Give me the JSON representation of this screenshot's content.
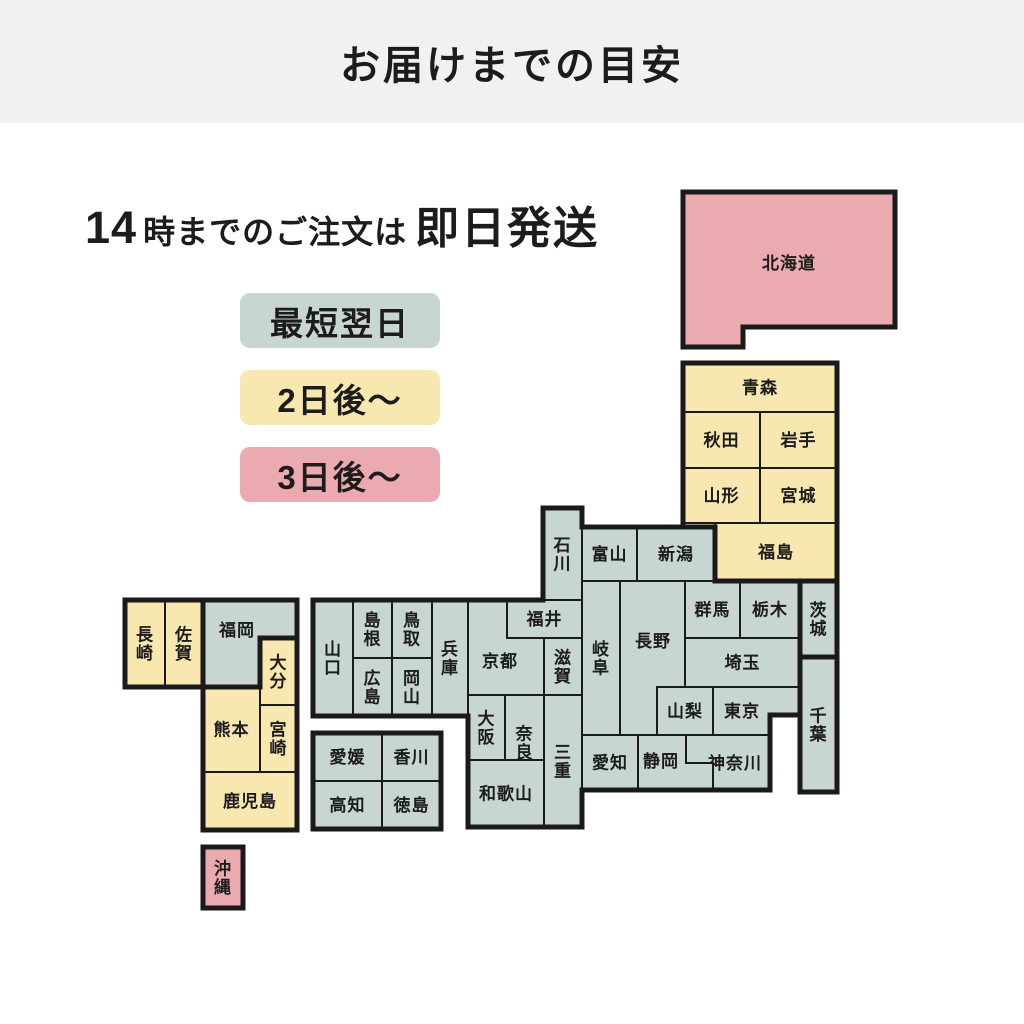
{
  "title": "お届けまでの目安",
  "subtitle": {
    "time": "14",
    "mid": "時までのご注文は",
    "emphasis": "即日発送"
  },
  "legend": [
    {
      "id": "next_day",
      "label": "最短翌日"
    },
    {
      "id": "two_days",
      "label": "2日後～"
    },
    {
      "id": "three_days",
      "label": "3日後～"
    }
  ],
  "colors": {
    "next_day": "#c8d6d3",
    "two_days": "#f8e7ae",
    "three_days": "#ebaab0",
    "line": "#1a1a1a",
    "header_bg": "#f0f1f3",
    "text": "#1c1c1c",
    "background": "#ffffff"
  },
  "map": {
    "tile_font_size": 17,
    "prefectures": [
      {
        "id": "hokkaido",
        "name": "北海道",
        "group": "three_days",
        "poly": [
          [
            683,
            192
          ],
          [
            895,
            192
          ],
          [
            895,
            327
          ],
          [
            743,
            327
          ],
          [
            743,
            347
          ],
          [
            683,
            347
          ]
        ],
        "label": [
          789,
          263
        ]
      },
      {
        "id": "aomori",
        "name": "青森",
        "group": "two_days",
        "rect": [
          683,
          363,
          154,
          49
        ]
      },
      {
        "id": "akita",
        "name": "秋田",
        "group": "two_days",
        "rect": [
          683,
          412,
          77,
          56
        ]
      },
      {
        "id": "iwate",
        "name": "岩手",
        "group": "two_days",
        "rect": [
          760,
          412,
          77,
          56
        ]
      },
      {
        "id": "yamagata",
        "name": "山形",
        "group": "two_days",
        "rect": [
          683,
          468,
          77,
          55
        ]
      },
      {
        "id": "miyagi",
        "name": "宮城",
        "group": "two_days",
        "rect": [
          760,
          468,
          77,
          55
        ]
      },
      {
        "id": "fukushima",
        "name": "福島",
        "group": "two_days",
        "rect": [
          715,
          523,
          122,
          58
        ]
      },
      {
        "id": "niigata",
        "name": "新潟",
        "group": "next_day",
        "rect": [
          637,
          527,
          78,
          54
        ]
      },
      {
        "id": "toyama",
        "name": "富山",
        "group": "next_day",
        "rect": [
          582,
          527,
          55,
          54
        ]
      },
      {
        "id": "ishikawa",
        "name": "石川",
        "group": "next_day",
        "rect": [
          543,
          508,
          39,
          92
        ],
        "vertical": true
      },
      {
        "id": "gifu",
        "name": "岐阜",
        "group": "next_day",
        "rect": [
          582,
          581,
          38,
          154
        ],
        "vertical": true
      },
      {
        "id": "nagano",
        "name": "長野",
        "group": "next_day",
        "rect": [
          620,
          581,
          67,
          154
        ],
        "label": [
          653,
          641
        ]
      },
      {
        "id": "gunma",
        "name": "群馬",
        "group": "next_day",
        "rect": [
          685,
          581,
          55,
          57
        ]
      },
      {
        "id": "tochigi",
        "name": "栃木",
        "group": "next_day",
        "rect": [
          740,
          581,
          60,
          57
        ]
      },
      {
        "id": "ibaraki",
        "name": "茨城",
        "group": "next_day",
        "rect": [
          800,
          581,
          37,
          76
        ],
        "vertical": true
      },
      {
        "id": "saitama",
        "name": "埼玉",
        "group": "next_day",
        "rect": [
          685,
          638,
          115,
          49
        ]
      },
      {
        "id": "yamanashi",
        "name": "山梨",
        "group": "next_day",
        "rect": [
          657,
          687,
          56,
          48
        ]
      },
      {
        "id": "tokyo",
        "name": "東京",
        "group": "next_day",
        "poly": [
          [
            713,
            687
          ],
          [
            800,
            687
          ],
          [
            800,
            715
          ],
          [
            770,
            715
          ],
          [
            770,
            735
          ],
          [
            713,
            735
          ]
        ],
        "label": [
          742,
          711
        ]
      },
      {
        "id": "chiba",
        "name": "千葉",
        "group": "next_day",
        "rect": [
          800,
          657,
          37,
          135
        ],
        "vertical": true
      },
      {
        "id": "kanagawa",
        "name": "神奈川",
        "group": "next_day",
        "rect": [
          686,
          735,
          84,
          55
        ],
        "label": [
          735,
          763
        ]
      },
      {
        "id": "shizuoka",
        "name": "静岡",
        "group": "next_day",
        "poly": [
          [
            638,
            735
          ],
          [
            686,
            735
          ],
          [
            686,
            763
          ],
          [
            713,
            763
          ],
          [
            713,
            790
          ],
          [
            638,
            790
          ]
        ],
        "label": [
          661,
          761
        ]
      },
      {
        "id": "aichi",
        "name": "愛知",
        "group": "next_day",
        "rect": [
          582,
          735,
          56,
          55
        ]
      },
      {
        "id": "kyoto",
        "name": "京都",
        "group": "next_day",
        "rect": [
          468,
          600,
          76,
          95
        ],
        "label": [
          500,
          661
        ]
      },
      {
        "id": "fukui",
        "name": "福井",
        "group": "next_day",
        "rect": [
          507,
          600,
          75,
          38
        ]
      },
      {
        "id": "shiga",
        "name": "滋賀",
        "group": "next_day",
        "rect": [
          544,
          638,
          38,
          57
        ],
        "vertical": true
      },
      {
        "id": "mie",
        "name": "三重",
        "group": "next_day",
        "rect": [
          544,
          695,
          38,
          132
        ],
        "vertical": true
      },
      {
        "id": "osaka",
        "name": "大阪",
        "group": "next_day",
        "rect": [
          468,
          695,
          37,
          65
        ],
        "vertical": true
      },
      {
        "id": "nara",
        "name": "奈良",
        "group": "next_day",
        "rect": [
          505,
          695,
          39,
          95
        ],
        "vertical": true
      },
      {
        "id": "wakayama",
        "name": "和歌山",
        "group": "next_day",
        "rect": [
          468,
          760,
          76,
          67
        ]
      },
      {
        "id": "hyogo",
        "name": "兵庫",
        "group": "next_day",
        "rect": [
          432,
          600,
          36,
          116
        ],
        "vertical": true
      },
      {
        "id": "tottori",
        "name": "鳥取",
        "group": "next_day",
        "rect": [
          392,
          600,
          40,
          58
        ],
        "vertical": true
      },
      {
        "id": "shimane",
        "name": "島根",
        "group": "next_day",
        "rect": [
          353,
          600,
          39,
          58
        ],
        "vertical": true
      },
      {
        "id": "okayama",
        "name": "岡山",
        "group": "next_day",
        "rect": [
          392,
          658,
          40,
          58
        ],
        "vertical": true
      },
      {
        "id": "hiroshima",
        "name": "広島",
        "group": "next_day",
        "rect": [
          353,
          658,
          39,
          58
        ],
        "vertical": true
      },
      {
        "id": "yamaguchi",
        "name": "山口",
        "group": "next_day",
        "rect": [
          313,
          600,
          40,
          116
        ],
        "vertical": true
      },
      {
        "id": "ehime",
        "name": "愛媛",
        "group": "next_day",
        "rect": [
          313,
          733,
          69,
          48
        ]
      },
      {
        "id": "kagawa",
        "name": "香川",
        "group": "next_day",
        "rect": [
          382,
          733,
          59,
          48
        ]
      },
      {
        "id": "kochi",
        "name": "高知",
        "group": "next_day",
        "rect": [
          313,
          781,
          69,
          48
        ]
      },
      {
        "id": "tokushima",
        "name": "徳島",
        "group": "next_day",
        "rect": [
          382,
          781,
          59,
          48
        ]
      },
      {
        "id": "fukuoka",
        "name": "福岡",
        "group": "next_day",
        "poly": [
          [
            203,
            600
          ],
          [
            297,
            600
          ],
          [
            297,
            638
          ],
          [
            260,
            638
          ],
          [
            260,
            687
          ],
          [
            203,
            687
          ]
        ],
        "label": [
          237,
          630
        ]
      },
      {
        "id": "oita",
        "name": "大分",
        "group": "two_days",
        "rect": [
          260,
          638,
          37,
          67
        ],
        "vertical": true
      },
      {
        "id": "nagasaki",
        "name": "長崎",
        "group": "two_days",
        "rect": [
          125,
          600,
          40,
          87
        ],
        "vertical": true
      },
      {
        "id": "saga",
        "name": "佐賀",
        "group": "two_days",
        "rect": [
          165,
          600,
          38,
          87
        ],
        "vertical": true
      },
      {
        "id": "kumamoto",
        "name": "熊本",
        "group": "two_days",
        "rect": [
          203,
          687,
          57,
          85
        ]
      },
      {
        "id": "miyazaki",
        "name": "宮崎",
        "group": "two_days",
        "rect": [
          260,
          705,
          37,
          67
        ],
        "vertical": true
      },
      {
        "id": "kagoshima",
        "name": "鹿児島",
        "group": "two_days",
        "rect": [
          203,
          772,
          94,
          58
        ]
      },
      {
        "id": "okinawa",
        "name": "沖縄",
        "group": "three_days",
        "rect": [
          203,
          847,
          40,
          61
        ],
        "vertical": true
      }
    ],
    "outlines": [
      {
        "id": "hokkaido-outline",
        "points": [
          [
            683,
            192
          ],
          [
            895,
            192
          ],
          [
            895,
            327
          ],
          [
            743,
            327
          ],
          [
            743,
            347
          ],
          [
            683,
            347
          ]
        ],
        "close": true
      },
      {
        "id": "tohoku-block-outline",
        "points": [
          [
            683,
            363
          ],
          [
            837,
            363
          ],
          [
            837,
            581
          ],
          [
            715,
            581
          ],
          [
            715,
            527
          ],
          [
            683,
            527
          ]
        ],
        "close": true
      },
      {
        "id": "honshu-outline",
        "points": [
          [
            543,
            508
          ],
          [
            582,
            508
          ],
          [
            582,
            527
          ],
          [
            715,
            527
          ],
          [
            715,
            581
          ],
          [
            837,
            581
          ],
          [
            837,
            792
          ],
          [
            800,
            792
          ],
          [
            800,
            715
          ],
          [
            770,
            715
          ],
          [
            770,
            790
          ],
          [
            582,
            790
          ],
          [
            582,
            827
          ],
          [
            468,
            827
          ],
          [
            468,
            716
          ],
          [
            313,
            716
          ],
          [
            313,
            600
          ],
          [
            543,
            600
          ]
        ],
        "close": true
      },
      {
        "id": "ibaraki-outline",
        "points": [
          [
            800,
            581
          ],
          [
            837,
            581
          ],
          [
            837,
            657
          ],
          [
            800,
            657
          ]
        ],
        "close": true
      },
      {
        "id": "chiba-outline",
        "points": [
          [
            800,
            657
          ],
          [
            837,
            657
          ],
          [
            837,
            792
          ],
          [
            800,
            792
          ]
        ],
        "close": true
      },
      {
        "id": "shikoku-outline",
        "points": [
          [
            313,
            733
          ],
          [
            441,
            733
          ],
          [
            441,
            829
          ],
          [
            313,
            829
          ]
        ],
        "close": true
      },
      {
        "id": "kyushu-outline",
        "points": [
          [
            125,
            600
          ],
          [
            297,
            600
          ],
          [
            297,
            830
          ],
          [
            203,
            830
          ],
          [
            203,
            687
          ],
          [
            125,
            687
          ]
        ],
        "close": true
      },
      {
        "id": "fukuoka-outline",
        "points": [
          [
            203,
            600
          ],
          [
            297,
            600
          ],
          [
            297,
            638
          ],
          [
            260,
            638
          ],
          [
            260,
            687
          ],
          [
            203,
            687
          ]
        ],
        "close": true
      },
      {
        "id": "okinawa-outline",
        "points": [
          [
            203,
            847
          ],
          [
            243,
            847
          ],
          [
            243,
            908
          ],
          [
            203,
            908
          ]
        ],
        "close": true
      }
    ]
  }
}
